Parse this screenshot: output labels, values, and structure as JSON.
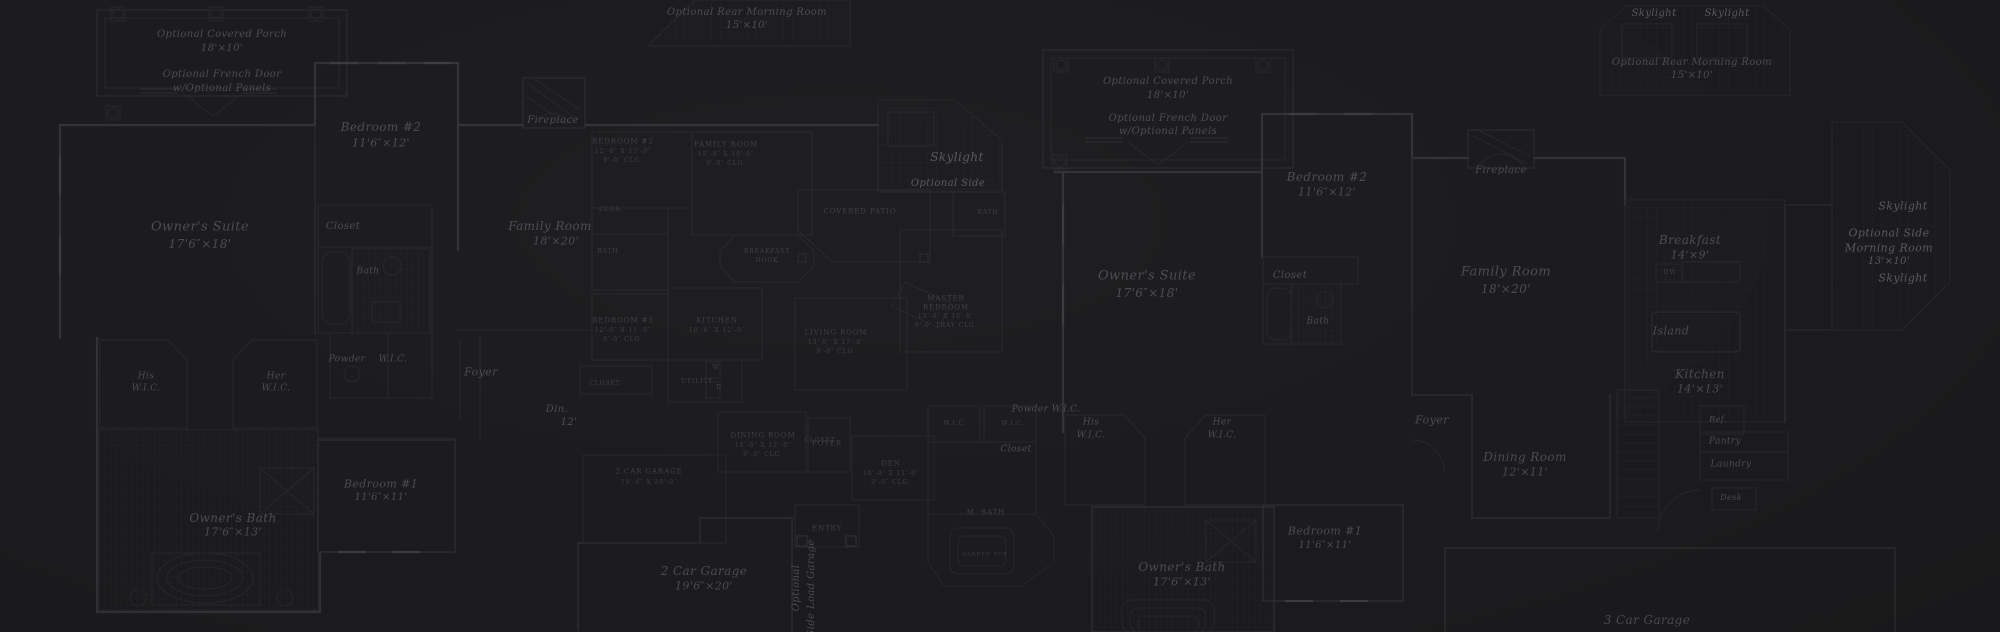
{
  "colors": {
    "background": "#1b1b1d",
    "wall": "#323236",
    "thin_line": "#27272b",
    "tile_grid": "#232327",
    "text": "#4b4b52",
    "text_caps": "#3e3e45",
    "text_bright": "#585862"
  },
  "labels": [
    {
      "id": "a-porch-line1",
      "text": "Optional Covered Porch",
      "x": 222,
      "y": 35,
      "s": 10
    },
    {
      "id": "a-porch-line2",
      "text": "18'×10'",
      "x": 222,
      "y": 49,
      "s": 10
    },
    {
      "id": "a-frenchdoor-line1",
      "text": "Optional French Door",
      "x": 222,
      "y": 75,
      "s": 10
    },
    {
      "id": "a-frenchdoor-line2",
      "text": "w/Optional Panels",
      "x": 222,
      "y": 89,
      "s": 10
    },
    {
      "id": "a-bedroom2-name",
      "text": "Bedroom #2",
      "x": 381,
      "y": 127,
      "s": 12
    },
    {
      "id": "a-bedroom2-dim",
      "text": "11'6″×12'",
      "x": 381,
      "y": 143,
      "s": 11
    },
    {
      "id": "a-owners-suite-name",
      "text": "Owner's Suite",
      "x": 200,
      "y": 227,
      "s": 13
    },
    {
      "id": "a-owners-suite-dim",
      "text": "17'6″×18'",
      "x": 200,
      "y": 244,
      "s": 12
    },
    {
      "id": "a-closet",
      "text": "Closet",
      "x": 343,
      "y": 227,
      "s": 10
    },
    {
      "id": "a-bath",
      "text": "Bath",
      "x": 368,
      "y": 272,
      "s": 9
    },
    {
      "id": "a-powder",
      "text": "Powder",
      "x": 347,
      "y": 360,
      "s": 9
    },
    {
      "id": "a-wic",
      "text": "W.I.C.",
      "x": 393,
      "y": 360,
      "s": 9
    },
    {
      "id": "a-his-wic-1",
      "text": "His",
      "x": 146,
      "y": 377,
      "s": 9
    },
    {
      "id": "a-his-wic-2",
      "text": "W.I.C.",
      "x": 146,
      "y": 389,
      "s": 9
    },
    {
      "id": "a-her-wic-1",
      "text": "Her",
      "x": 276,
      "y": 377,
      "s": 9
    },
    {
      "id": "a-her-wic-2",
      "text": "W.I.C.",
      "x": 276,
      "y": 389,
      "s": 9
    },
    {
      "id": "a-foyer",
      "text": "Foyer",
      "x": 481,
      "y": 372,
      "s": 11
    },
    {
      "id": "a-family-room-name",
      "text": "Family Room",
      "x": 550,
      "y": 226,
      "s": 12
    },
    {
      "id": "a-family-room-dim",
      "text": "18'×20'",
      "x": 556,
      "y": 241,
      "s": 11
    },
    {
      "id": "a-dining-frag-1",
      "text": "Din.",
      "x": 557,
      "y": 410,
      "s": 10
    },
    {
      "id": "a-dining-frag-2",
      "text": "12'",
      "x": 569,
      "y": 423,
      "s": 10
    },
    {
      "id": "a-fireplace",
      "text": "Fireplace",
      "x": 553,
      "y": 121,
      "s": 10
    },
    {
      "id": "a-owners-bath-name",
      "text": "Owner's Bath",
      "x": 233,
      "y": 518,
      "s": 12
    },
    {
      "id": "a-owners-bath-dim",
      "text": "17'6″×13'",
      "x": 233,
      "y": 532,
      "s": 11
    },
    {
      "id": "a-bedroom1-name",
      "text": "Bedroom #1",
      "x": 381,
      "y": 484,
      "s": 11
    },
    {
      "id": "a-bedroom1-dim",
      "text": "11'6″×11'",
      "x": 381,
      "y": 498,
      "s": 10
    },
    {
      "id": "a-garage-name",
      "text": "2 Car Garage",
      "x": 704,
      "y": 571,
      "s": 12
    },
    {
      "id": "a-garage-dim",
      "text": "19'6″×20'",
      "x": 704,
      "y": 586,
      "s": 11
    },
    {
      "id": "a-sideload-1",
      "text": "Optional",
      "x": 797,
      "y": 588,
      "s": 10,
      "rot": -90
    },
    {
      "id": "a-sideload-2",
      "text": "Side Load Garage",
      "x": 812,
      "y": 588,
      "s": 10,
      "rot": -90
    },
    {
      "id": "a-entry",
      "text": "ENTRY",
      "x": 827,
      "y": 529,
      "s": 7,
      "cls": "caps"
    },
    {
      "id": "a-skylight",
      "text": "Skylight",
      "x": 957,
      "y": 157,
      "s": 12,
      "cls": "bright"
    },
    {
      "id": "a-optional-side",
      "text": "Optional Side",
      "x": 948,
      "y": 184,
      "s": 10,
      "cls": "bright"
    },
    {
      "id": "ab-rear-morning-1",
      "text": "Optional Rear Morning Room",
      "x": 747,
      "y": 13,
      "s": 10
    },
    {
      "id": "ab-rear-morning-2",
      "text": "15'×10'",
      "x": 747,
      "y": 26,
      "s": 10
    },
    {
      "id": "b-bedroom2-1",
      "text": "BEDROOM #2",
      "x": 623,
      "y": 142,
      "s": 7,
      "cls": "caps"
    },
    {
      "id": "b-bedroom2-2",
      "text": "12'-0″ X 13'-0″",
      "x": 623,
      "y": 152,
      "s": 6,
      "cls": "caps"
    },
    {
      "id": "b-bedroom2-3",
      "text": "9'-0″ CLG.",
      "x": 623,
      "y": 161,
      "s": 6,
      "cls": "caps"
    },
    {
      "id": "b-family-1",
      "text": "FAMILY ROOM",
      "x": 726,
      "y": 145,
      "s": 7,
      "cls": "caps"
    },
    {
      "id": "b-family-2",
      "text": "15'-0″ X 19'-0″",
      "x": 726,
      "y": 155,
      "s": 6,
      "cls": "caps"
    },
    {
      "id": "b-family-3",
      "text": "9'-0″ CLG.",
      "x": 726,
      "y": 164,
      "s": 6,
      "cls": "caps"
    },
    {
      "id": "b-clos",
      "text": "CLOS.",
      "x": 611,
      "y": 210,
      "s": 6,
      "cls": "caps"
    },
    {
      "id": "b-bath",
      "text": "BATH",
      "x": 608,
      "y": 252,
      "s": 6,
      "cls": "caps"
    },
    {
      "id": "b-bedroom3-1",
      "text": "BEDROOM #3",
      "x": 623,
      "y": 321,
      "s": 7,
      "cls": "caps"
    },
    {
      "id": "b-bedroom3-2",
      "text": "12'-0″ X 11'-0″",
      "x": 623,
      "y": 331,
      "s": 6,
      "cls": "caps"
    },
    {
      "id": "b-bedroom3-3",
      "text": "9'-0″ CLG.",
      "x": 623,
      "y": 340,
      "s": 6,
      "cls": "caps"
    },
    {
      "id": "b-kitchen-1",
      "text": "KITCHEN",
      "x": 717,
      "y": 321,
      "s": 7,
      "cls": "caps"
    },
    {
      "id": "b-kitchen-2",
      "text": "10'-0″ X 12'-0″",
      "x": 717,
      "y": 331,
      "s": 6,
      "cls": "caps"
    },
    {
      "id": "b-closet",
      "text": "CLOSET",
      "x": 605,
      "y": 384,
      "s": 6,
      "cls": "caps"
    },
    {
      "id": "b-utility",
      "text": "UTILITY",
      "x": 697,
      "y": 382,
      "s": 6,
      "cls": "caps"
    },
    {
      "id": "b-washer",
      "text": "W",
      "x": 716,
      "y": 368,
      "s": 6,
      "cls": "caps"
    },
    {
      "id": "b-dryer",
      "text": "D",
      "x": 719,
      "y": 388,
      "s": 6,
      "cls": "caps"
    },
    {
      "id": "b-living-1",
      "text": "LIVING ROOM",
      "x": 836,
      "y": 333,
      "s": 7,
      "cls": "caps"
    },
    {
      "id": "b-living-2",
      "text": "13'-0″ X 17'-0″",
      "x": 836,
      "y": 343,
      "s": 6,
      "cls": "caps"
    },
    {
      "id": "b-living-3",
      "text": "9'-0″ CLG.",
      "x": 836,
      "y": 352,
      "s": 6,
      "cls": "caps"
    },
    {
      "id": "b-dining-1",
      "text": "DINING ROOM",
      "x": 763,
      "y": 436,
      "s": 7,
      "cls": "caps"
    },
    {
      "id": "b-dining-2",
      "text": "10'-0″ X 12'-0″",
      "x": 763,
      "y": 446,
      "s": 6,
      "cls": "caps"
    },
    {
      "id": "b-dining-3",
      "text": "9'-0″ CLG.",
      "x": 763,
      "y": 455,
      "s": 6,
      "cls": "caps"
    },
    {
      "id": "b-foyer",
      "text": "FOYER",
      "x": 827,
      "y": 444,
      "s": 7,
      "cls": "caps"
    },
    {
      "id": "b-den-1",
      "text": "DEN",
      "x": 891,
      "y": 464,
      "s": 7,
      "cls": "caps"
    },
    {
      "id": "b-den-2",
      "text": "10'-0″ X 11'-0″",
      "x": 891,
      "y": 474,
      "s": 6,
      "cls": "caps"
    },
    {
      "id": "b-den-3",
      "text": "9'-0″ CLG.",
      "x": 891,
      "y": 483,
      "s": 6,
      "cls": "caps"
    },
    {
      "id": "b-garage-1",
      "text": "2 CAR GARAGE",
      "x": 649,
      "y": 472,
      "s": 7,
      "cls": "caps"
    },
    {
      "id": "b-garage-2",
      "text": "19'-6″ X 20'-0″",
      "x": 649,
      "y": 483,
      "s": 6,
      "cls": "caps"
    },
    {
      "id": "b-master-1",
      "text": "MASTER",
      "x": 946,
      "y": 299,
      "s": 7,
      "cls": "caps"
    },
    {
      "id": "b-master-2",
      "text": "BEDROOM",
      "x": 946,
      "y": 308,
      "s": 7,
      "cls": "caps"
    },
    {
      "id": "b-master-3",
      "text": "13'-0″ X 16'-0″",
      "x": 946,
      "y": 317,
      "s": 6,
      "cls": "caps"
    },
    {
      "id": "b-master-4",
      "text": "9'-0″ TRAY CLG.",
      "x": 946,
      "y": 326,
      "s": 6,
      "cls": "caps"
    },
    {
      "id": "b-covered-patio",
      "text": "COVERED PATIO",
      "x": 860,
      "y": 212,
      "s": 7,
      "cls": "caps"
    },
    {
      "id": "b-bath2",
      "text": "BATH",
      "x": 988,
      "y": 213,
      "s": 6,
      "cls": "caps"
    },
    {
      "id": "b-wic-left",
      "text": "W.I.C.",
      "x": 955,
      "y": 424,
      "s": 6,
      "cls": "caps"
    },
    {
      "id": "b-wic-right",
      "text": "W.I.C.",
      "x": 1013,
      "y": 424,
      "s": 6,
      "cls": "caps"
    },
    {
      "id": "b-mbath",
      "text": "M. BATH",
      "x": 986,
      "y": 513,
      "s": 7,
      "cls": "caps"
    },
    {
      "id": "b-garden-tub",
      "text": "GARDEN TUB",
      "x": 985,
      "y": 555,
      "s": 5,
      "cls": "caps"
    },
    {
      "id": "b-nook-1",
      "text": "BREAKFAST",
      "x": 767,
      "y": 252,
      "s": 6,
      "cls": "caps"
    },
    {
      "id": "b-nook-2",
      "text": "NOOK",
      "x": 767,
      "y": 261,
      "s": 6,
      "cls": "caps"
    },
    {
      "id": "b-closet2",
      "text": "CLOSET",
      "x": 820,
      "y": 441,
      "s": 6,
      "cls": "caps"
    },
    {
      "id": "c-porch-line1",
      "text": "Optional Covered Porch",
      "x": 1168,
      "y": 82,
      "s": 10
    },
    {
      "id": "c-porch-line2",
      "text": "18'×10'",
      "x": 1168,
      "y": 96,
      "s": 10
    },
    {
      "id": "c-frenchdoor-line1",
      "text": "Optional French Door",
      "x": 1168,
      "y": 119,
      "s": 10
    },
    {
      "id": "c-frenchdoor-line2",
      "text": "w/Optional Panels",
      "x": 1168,
      "y": 132,
      "s": 10
    },
    {
      "id": "c-bedroom2-name",
      "text": "Bedroom #2",
      "x": 1327,
      "y": 177,
      "s": 12
    },
    {
      "id": "c-bedroom2-dim",
      "text": "11'6″×12'",
      "x": 1327,
      "y": 192,
      "s": 11
    },
    {
      "id": "c-fireplace",
      "text": "Fireplace",
      "x": 1501,
      "y": 171,
      "s": 10
    },
    {
      "id": "c-owners-suite-name",
      "text": "Owner's Suite",
      "x": 1147,
      "y": 276,
      "s": 13
    },
    {
      "id": "c-owners-suite-dim",
      "text": "17'6″×18'",
      "x": 1147,
      "y": 293,
      "s": 12
    },
    {
      "id": "c-closet",
      "text": "Closet",
      "x": 1290,
      "y": 276,
      "s": 10
    },
    {
      "id": "c-bath",
      "text": "Bath",
      "x": 1318,
      "y": 322,
      "s": 9
    },
    {
      "id": "c-family-room-name",
      "text": "Family Room",
      "x": 1506,
      "y": 272,
      "s": 13
    },
    {
      "id": "c-family-room-dim",
      "text": "18'×20'",
      "x": 1506,
      "y": 289,
      "s": 12
    },
    {
      "id": "c-breakfast-name",
      "text": "Breakfast",
      "x": 1690,
      "y": 240,
      "s": 12
    },
    {
      "id": "c-breakfast-dim",
      "text": "14'×9'",
      "x": 1690,
      "y": 255,
      "s": 11
    },
    {
      "id": "c-dw",
      "text": "DW",
      "x": 1670,
      "y": 273,
      "s": 6,
      "cls": "caps"
    },
    {
      "id": "c-island",
      "text": "Island",
      "x": 1671,
      "y": 331,
      "s": 11
    },
    {
      "id": "c-kitchen-name",
      "text": "Kitchen",
      "x": 1700,
      "y": 374,
      "s": 12
    },
    {
      "id": "c-kitchen-dim",
      "text": "14'×13'",
      "x": 1700,
      "y": 389,
      "s": 11
    },
    {
      "id": "c-skylight-upper",
      "text": "Skylight",
      "x": 1903,
      "y": 206,
      "s": 11,
      "cls": "bright"
    },
    {
      "id": "c-side-morning-1",
      "text": "Optional Side",
      "x": 1889,
      "y": 233,
      "s": 11,
      "cls": "bright"
    },
    {
      "id": "c-side-morning-2",
      "text": "Morning Room",
      "x": 1889,
      "y": 248,
      "s": 11,
      "cls": "bright"
    },
    {
      "id": "c-side-morning-3",
      "text": "13'×10'",
      "x": 1889,
      "y": 262,
      "s": 10,
      "cls": "bright"
    },
    {
      "id": "c-skylight-lower",
      "text": "Skylight",
      "x": 1903,
      "y": 278,
      "s": 11,
      "cls": "bright"
    },
    {
      "id": "c-roof-skylight-1",
      "text": "Skylight",
      "x": 1654,
      "y": 14,
      "s": 10,
      "cls": "bright"
    },
    {
      "id": "c-roof-skylight-2",
      "text": "Skylight",
      "x": 1727,
      "y": 14,
      "s": 10,
      "cls": "bright"
    },
    {
      "id": "c-rear-morning-1",
      "text": "Optional Rear Morning Room",
      "x": 1692,
      "y": 63,
      "s": 10
    },
    {
      "id": "c-rear-morning-2",
      "text": "15'×10'",
      "x": 1692,
      "y": 76,
      "s": 10
    },
    {
      "id": "c-his-wic-1",
      "text": "His",
      "x": 1091,
      "y": 423,
      "s": 9
    },
    {
      "id": "c-his-wic-2",
      "text": "W.I.C.",
      "x": 1091,
      "y": 436,
      "s": 9
    },
    {
      "id": "c-her-wic-1",
      "text": "Her",
      "x": 1222,
      "y": 423,
      "s": 9
    },
    {
      "id": "c-her-wic-2",
      "text": "W.I.C.",
      "x": 1222,
      "y": 436,
      "s": 9
    },
    {
      "id": "c-powder",
      "text": "Powder",
      "x": 1030,
      "y": 410,
      "s": 9
    },
    {
      "id": "c-wic",
      "text": "W.I.C.",
      "x": 1066,
      "y": 410,
      "s": 9
    },
    {
      "id": "c-closet2",
      "text": "Closet",
      "x": 1016,
      "y": 450,
      "s": 9
    },
    {
      "id": "c-foyer",
      "text": "Foyer",
      "x": 1432,
      "y": 420,
      "s": 11
    },
    {
      "id": "c-dining-name",
      "text": "Dining Room",
      "x": 1525,
      "y": 457,
      "s": 12
    },
    {
      "id": "c-dining-dim",
      "text": "12'×11'",
      "x": 1525,
      "y": 472,
      "s": 11
    },
    {
      "id": "c-ref",
      "text": "Ref.",
      "x": 1718,
      "y": 420,
      "s": 8
    },
    {
      "id": "c-pantry",
      "text": "Pantry",
      "x": 1725,
      "y": 442,
      "s": 9
    },
    {
      "id": "c-laundry",
      "text": "Laundry",
      "x": 1731,
      "y": 465,
      "s": 9
    },
    {
      "id": "c-desk",
      "text": "Desk",
      "x": 1731,
      "y": 498,
      "s": 8
    },
    {
      "id": "c-owners-bath-name",
      "text": "Owner's Bath",
      "x": 1182,
      "y": 567,
      "s": 12
    },
    {
      "id": "c-owners-bath-dim",
      "text": "17'6″×13'",
      "x": 1182,
      "y": 582,
      "s": 11
    },
    {
      "id": "c-bedroom1-name",
      "text": "Bedroom #1",
      "x": 1325,
      "y": 531,
      "s": 11
    },
    {
      "id": "c-bedroom1-dim",
      "text": "11'6″×11'",
      "x": 1325,
      "y": 546,
      "s": 10
    },
    {
      "id": "c-garage",
      "text": "3 Car Garage",
      "x": 1647,
      "y": 620,
      "s": 12
    }
  ]
}
